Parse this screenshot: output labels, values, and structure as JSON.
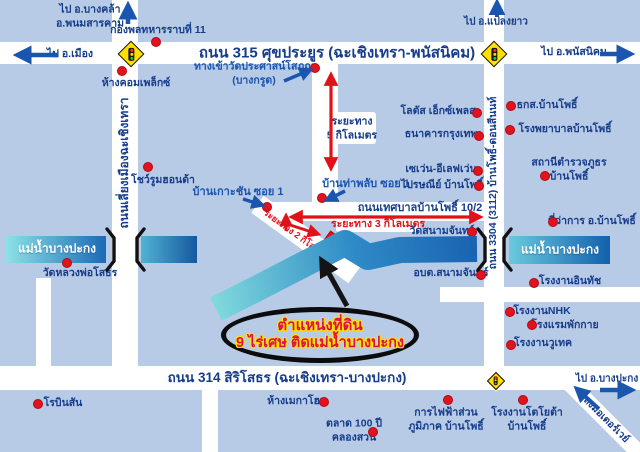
{
  "palette": {
    "bg": "#b7cae6",
    "road": "#ffffff",
    "navy": "#163d8b",
    "blue": "#1a55b0",
    "red": "#e01218",
    "black": "#141414",
    "white": "#ffffff",
    "plot_red": "#ea1217",
    "ellipse_text": "#dd0f4d",
    "ellipse_glow": "#ffe300",
    "sign_yellow": "#ffdf00"
  },
  "roads": [
    {
      "name": "road-315",
      "x": 0,
      "y": 42,
      "w": 640,
      "h": 22
    },
    {
      "name": "road-314",
      "x": 0,
      "y": 366,
      "w": 640,
      "h": 24
    },
    {
      "name": "road-tessaban",
      "x": 262,
      "y": 202,
      "w": 242,
      "h": 19
    },
    {
      "name": "road-factory",
      "x": 440,
      "y": 287,
      "w": 200,
      "h": 15
    },
    {
      "name": "road-liang-mueang",
      "x": 112,
      "y": 0,
      "w": 26,
      "h": 368
    },
    {
      "name": "road-stub-left",
      "x": 36,
      "y": 278,
      "w": 15,
      "h": 90
    },
    {
      "name": "road-middle",
      "x": 312,
      "y": 64,
      "w": 26,
      "h": 150
    },
    {
      "name": "road-3304",
      "x": 484,
      "y": 0,
      "w": 20,
      "h": 366
    },
    {
      "name": "road-below-314",
      "x": 202,
      "y": 390,
      "w": 16,
      "h": 62
    },
    {
      "name": "road-diagonal",
      "x": 246,
      "y": 229,
      "w": 120,
      "h": 21,
      "rot": 36
    },
    {
      "name": "road-motorway",
      "x": 549,
      "y": 411,
      "w": 112,
      "h": 16,
      "rot": 45
    }
  ],
  "chips": [
    {
      "name": "chip-5km-label",
      "x": 330,
      "y": 112,
      "w": 46,
      "h": 32
    },
    {
      "name": "chip-3km-label",
      "x": 336,
      "y": 218,
      "w": 84,
      "h": 14
    }
  ],
  "rivers": {
    "segments": [
      {
        "name": "river-left",
        "x": 6,
        "y": 236,
        "w": 100,
        "h": 27,
        "from": "#8ce2e6",
        "to": "#1b6ab6"
      },
      {
        "name": "river-left-2",
        "x": 141,
        "y": 236,
        "w": 56,
        "h": 27,
        "from": "#52b2d4",
        "to": "#15599e"
      },
      {
        "name": "river-right",
        "x": 509,
        "y": 236,
        "w": 101,
        "h": 28,
        "from": "#68cadd",
        "to": "#1360ad"
      }
    ],
    "flow": {
      "name": "river-middle",
      "points": "216,309 252,291 318,257 345,243 368,257 400,250 477,249",
      "width": 26,
      "from": "#7fd8dc",
      "mid": "#2e8ac6",
      "to": "#1a63b0"
    },
    "labels": [
      {
        "name": "river-label-left",
        "text": "แม่น้ำบางปะกง",
        "x": 57,
        "y": 249,
        "size": 12
      },
      {
        "name": "river-label-right",
        "text": "แม่น้ำบางปะกง",
        "x": 560,
        "y": 250,
        "size": 12
      }
    ]
  },
  "bridges": [
    {
      "name": "bridge-bracket",
      "d": "M107,229 L114,238 L114,261 L107,270"
    },
    {
      "name": "bridge-bracket",
      "d": "M144,229 L137,238 L137,261 L144,270"
    },
    {
      "name": "bridge-bracket",
      "d": "M478,229 L485,238 L485,261 L478,270"
    },
    {
      "name": "bridge-bracket",
      "d": "M511,229 L504,238 L504,261 L511,270"
    }
  ],
  "signs": [
    {
      "name": "traffic-sign-315-liang",
      "x": 131,
      "y": 54,
      "size": 19
    },
    {
      "name": "traffic-sign-315-3304",
      "x": 494,
      "y": 54,
      "size": 19
    },
    {
      "name": "traffic-sign-314-3304",
      "x": 496,
      "y": 381,
      "size": 13
    }
  ],
  "texts": [
    {
      "name": "road-315-label",
      "text": "ถนน 315 ศุขประยูร (ฉะเชิงเทรา-พนัสนิคม)",
      "x": 337,
      "y": 53,
      "size": 15,
      "color": "navy"
    },
    {
      "name": "road-314-label",
      "text": "ถนน 314 สิริโสธร (ฉะเชิงเทรา-บางปะกง)",
      "x": 287,
      "y": 378,
      "size": 13.5,
      "color": "navy"
    },
    {
      "name": "road-tessaban-label",
      "text": "ถนนเทศบาลบ้านโพธิ์ 10/2",
      "x": 420,
      "y": 208,
      "size": 11,
      "color": "navy"
    },
    {
      "name": "road-liang-mueang-label",
      "text": "ถนนเลี่ยงเมืองฉะเชิงเทรา",
      "x": 125,
      "y": 163,
      "size": 12,
      "color": "navy",
      "rot": -90
    },
    {
      "name": "road-3304-label",
      "text": "ถนน 3304 (3112) บ้านโพธิ์-ดอนสีนนท์",
      "x": 494,
      "y": 183,
      "size": 10.5,
      "color": "navy",
      "rot": -90
    },
    {
      "name": "road-motorway-label",
      "text": "ลงมอเตอร์เวย์",
      "x": 606,
      "y": 420,
      "size": 10,
      "color": "navy",
      "rot": 45
    },
    {
      "name": "distance-5km-label",
      "lines": [
        "ระยะทาง",
        "5 กิโลเมตร"
      ],
      "x": 352,
      "y": 129,
      "size": 10.5,
      "color": "navy"
    },
    {
      "name": "distance-3km-label",
      "text": "ระยะทาง 3 กิโลเมตร",
      "x": 378,
      "y": 225,
      "size": 10.5,
      "color": "red"
    },
    {
      "name": "distance-2km-label",
      "text": "ระยะทาง 2 กิโลเมตร",
      "x": 297,
      "y": 236,
      "size": 9,
      "color": "red",
      "rot": 36
    },
    {
      "name": "direction-bangkhla",
      "lines": [
        "ไป อ.บางคล้า",
        "อ.พนมสารคาม"
      ],
      "x": 90,
      "y": 17,
      "size": 10.5,
      "color": "navy"
    },
    {
      "name": "direction-mueang",
      "text": "ไป อ.เมือง",
      "x": 70,
      "y": 55,
      "size": 10.5,
      "color": "navy"
    },
    {
      "name": "direction-plaengyao",
      "text": "ไป อ.แปลงยาว",
      "x": 496,
      "y": 22,
      "size": 10,
      "color": "navy"
    },
    {
      "name": "direction-phanatnikhom",
      "text": "ไป อ.พนัสนิคม",
      "x": 574,
      "y": 53,
      "size": 10.5,
      "color": "navy"
    },
    {
      "name": "direction-bangpakong",
      "text": "ไป อ.บางปะกง",
      "x": 607,
      "y": 379,
      "size": 10,
      "color": "navy"
    },
    {
      "name": "callout-wat-entrance",
      "lines": [
        "ทางเข้าวัดประศาสน์โสภณ",
        "(บางกรูด)"
      ],
      "x": 254,
      "y": 74,
      "size": 10.5,
      "color": "blue"
    },
    {
      "name": "callout-ban-koh-chan",
      "text": "บ้านเกาะชัน ซอย 1",
      "x": 238,
      "y": 192,
      "size": 11,
      "color": "blue"
    },
    {
      "name": "callout-ban-tha-phlap",
      "text": "บ้านท่าพลับ ซอย 1",
      "x": 366,
      "y": 184,
      "size": 11,
      "color": "blue"
    }
  ],
  "pois": [
    {
      "name": "poi-army-division-11",
      "text": "กองพลทหารราบที่ 11",
      "dot": [
        156,
        42
      ],
      "label": [
        158,
        31
      ]
    },
    {
      "name": "poi-complex-mall",
      "text": "ห้างคอมเพล็กซ์",
      "dot": [
        122,
        71
      ],
      "label": [
        136,
        84
      ]
    },
    {
      "name": "poi-honda-showroom",
      "text": "โชว์รูมฮอนด้า",
      "dot": [
        148,
        167
      ],
      "label": [
        163,
        181
      ]
    },
    {
      "name": "poi-lotus-express",
      "text": "โลตัส เอ็กซ์เพลส",
      "dot": [
        477,
        113
      ],
      "label": [
        438,
        112
      ]
    },
    {
      "name": "poi-bangkok-bank",
      "text": "ธนาคารกรุงเทพ",
      "dot": [
        479,
        136
      ],
      "label": [
        441,
        135
      ]
    },
    {
      "name": "poi-seven-eleven",
      "text": "เซเว่น-อีเลฟเว่น",
      "dot": [
        478,
        171
      ],
      "label": [
        441,
        170
      ]
    },
    {
      "name": "poi-post-office",
      "text": "ไปรษณีย์ บ้านโพธิ์",
      "dot": [
        479,
        186
      ],
      "label": [
        442,
        186
      ]
    },
    {
      "name": "poi-baac-banpho",
      "text": "ธกส.บ้านโพธิ์",
      "dot": [
        511,
        106
      ],
      "label": [
        547,
        106
      ]
    },
    {
      "name": "poi-banpho-hospital",
      "text": "โรงพยาบาลบ้านโพธิ์",
      "dot": [
        510,
        130
      ],
      "label": [
        565,
        130
      ]
    },
    {
      "name": "poi-police-station",
      "lines": [
        "สถานีตำรวจภูธร",
        "บ้านโพธิ์"
      ],
      "dot": [
        545,
        176
      ],
      "label": [
        569,
        170
      ]
    },
    {
      "name": "poi-district-office",
      "text": "ที่ว่าการ อ.บ้านโพธิ์",
      "dot": [
        553,
        222
      ],
      "label": [
        592,
        222
      ]
    },
    {
      "name": "poi-wat-sanam-chan",
      "text": "วัดสนามจันทร์",
      "dot": [
        472,
        232
      ],
      "label": [
        442,
        232
      ]
    },
    {
      "name": "poi-obt-sanam-chan",
      "text": "อบต.สนามจันทร์",
      "dot": [
        481,
        275
      ],
      "label": [
        451,
        274
      ]
    },
    {
      "name": "poi-intouch-factory",
      "text": "โรงงานอินทัช",
      "dot": [
        534,
        283
      ],
      "label": [
        570,
        282
      ]
    },
    {
      "name": "poi-nhk-factory",
      "text": "โรงงานNHK",
      "dot": [
        510,
        312
      ],
      "label": [
        542,
        312
      ]
    },
    {
      "name": "poi-phakkai-hotel",
      "text": "โรงแรมพักกาย",
      "dot": [
        532,
        325
      ],
      "label": [
        565,
        326
      ]
    },
    {
      "name": "poi-wutec-factory",
      "text": "โรงงานวูเทค",
      "dot": [
        511,
        345
      ],
      "label": [
        543,
        344
      ]
    },
    {
      "name": "poi-pea-banpho",
      "lines": [
        "การไฟฟ้าส่วน",
        "ภูมิภาค บ้านโพธิ์"
      ],
      "dot": [
        448,
        400
      ],
      "label": [
        446,
        420
      ]
    },
    {
      "name": "poi-toyota-factory",
      "lines": [
        "โรงงานโตโยต้า",
        "บ้านโพธิ์"
      ],
      "dot": [
        523,
        400
      ],
      "label": [
        527,
        420
      ]
    },
    {
      "name": "poi-wat-luang-pho-sothon",
      "text": "วัดหลวงพ่อโสธร",
      "dot": [
        67,
        263
      ],
      "label": [
        80,
        274
      ]
    },
    {
      "name": "poi-robinson",
      "text": "โรบินสัน",
      "dot": [
        38,
        404
      ],
      "label": [
        63,
        404
      ]
    },
    {
      "name": "poi-megahome",
      "text": "ห้างเมกาโฮม",
      "dot": [
        324,
        402
      ],
      "label": [
        297,
        402
      ]
    },
    {
      "name": "poi-market-100y",
      "lines": [
        "ตลาด 100 ปี",
        "คลองสวน"
      ],
      "dot": [
        373,
        432
      ],
      "label": [
        354,
        431
      ]
    },
    {
      "name": "poi-wat-entrance-dot",
      "dot": [
        315,
        68
      ]
    },
    {
      "name": "poi-ban-koh-chan-dot",
      "dot": [
        267,
        207
      ]
    },
    {
      "name": "poi-ban-tha-phlap-dot",
      "dot": [
        322,
        198
      ]
    }
  ],
  "arrows": [
    {
      "name": "arrow-up-bangkhla",
      "pts": [
        128,
        24,
        128,
        6
      ],
      "color": "blue",
      "w": 4.5
    },
    {
      "name": "arrow-left-mueang",
      "pts": [
        58,
        55,
        18,
        55
      ],
      "color": "blue",
      "w": 4.5
    },
    {
      "name": "arrow-up-plaengyao",
      "pts": [
        497,
        17,
        497,
        3
      ],
      "color": "blue",
      "w": 4
    },
    {
      "name": "arrow-right-phanatnikhom",
      "pts": [
        600,
        54,
        630,
        54
      ],
      "color": "blue",
      "w": 4.5
    },
    {
      "name": "arrow-right-bangpakong",
      "pts": [
        600,
        390,
        631,
        390
      ],
      "color": "blue",
      "w": 4.5
    },
    {
      "name": "arrow-motorway",
      "pts": [
        599,
        409,
        577,
        389
      ],
      "color": "blue",
      "w": 4
    },
    {
      "name": "arrow-wat-entrance",
      "pts": [
        284,
        81,
        310,
        70
      ],
      "color": "blue",
      "w": 3.5
    },
    {
      "name": "arrow-ban-koh-chan",
      "pts": [
        243,
        199,
        262,
        205
      ],
      "color": "blue",
      "w": 3.5
    },
    {
      "name": "arrow-ban-tha-phlap",
      "pts": [
        345,
        191,
        327,
        200
      ],
      "color": "blue",
      "w": 3.5
    },
    {
      "name": "arrow-distance-5km",
      "pts": [
        331,
        75,
        331,
        168
      ],
      "color": "red",
      "w": 3.2,
      "double": true
    },
    {
      "name": "arrow-distance-3km",
      "pts": [
        292,
        217,
        480,
        217
      ],
      "color": "red",
      "w": 3.2,
      "double": true
    },
    {
      "name": "arrow-2km-up",
      "pts": [
        286,
        231,
        286,
        216
      ],
      "color": "red",
      "w": 3
    },
    {
      "name": "arrow-2km-diag",
      "pts": [
        287,
        224,
        318,
        234
      ],
      "color": "red",
      "w": 3
    },
    {
      "name": "arrow-land-plot-pointer",
      "pts": [
        347,
        306,
        322,
        261
      ],
      "color": "black",
      "w": 5
    }
  ],
  "land_plot": {
    "name": "land-plot",
    "x": 328,
    "y": 251,
    "w": 20,
    "h": 36,
    "rot": 36
  },
  "ellipse": {
    "lines": [
      "ตำแหน่งที่ดิน",
      "9 ไร่เศษ ติดแม่น้ำบางปะกง"
    ],
    "size1": 15,
    "size2": 14.5
  }
}
